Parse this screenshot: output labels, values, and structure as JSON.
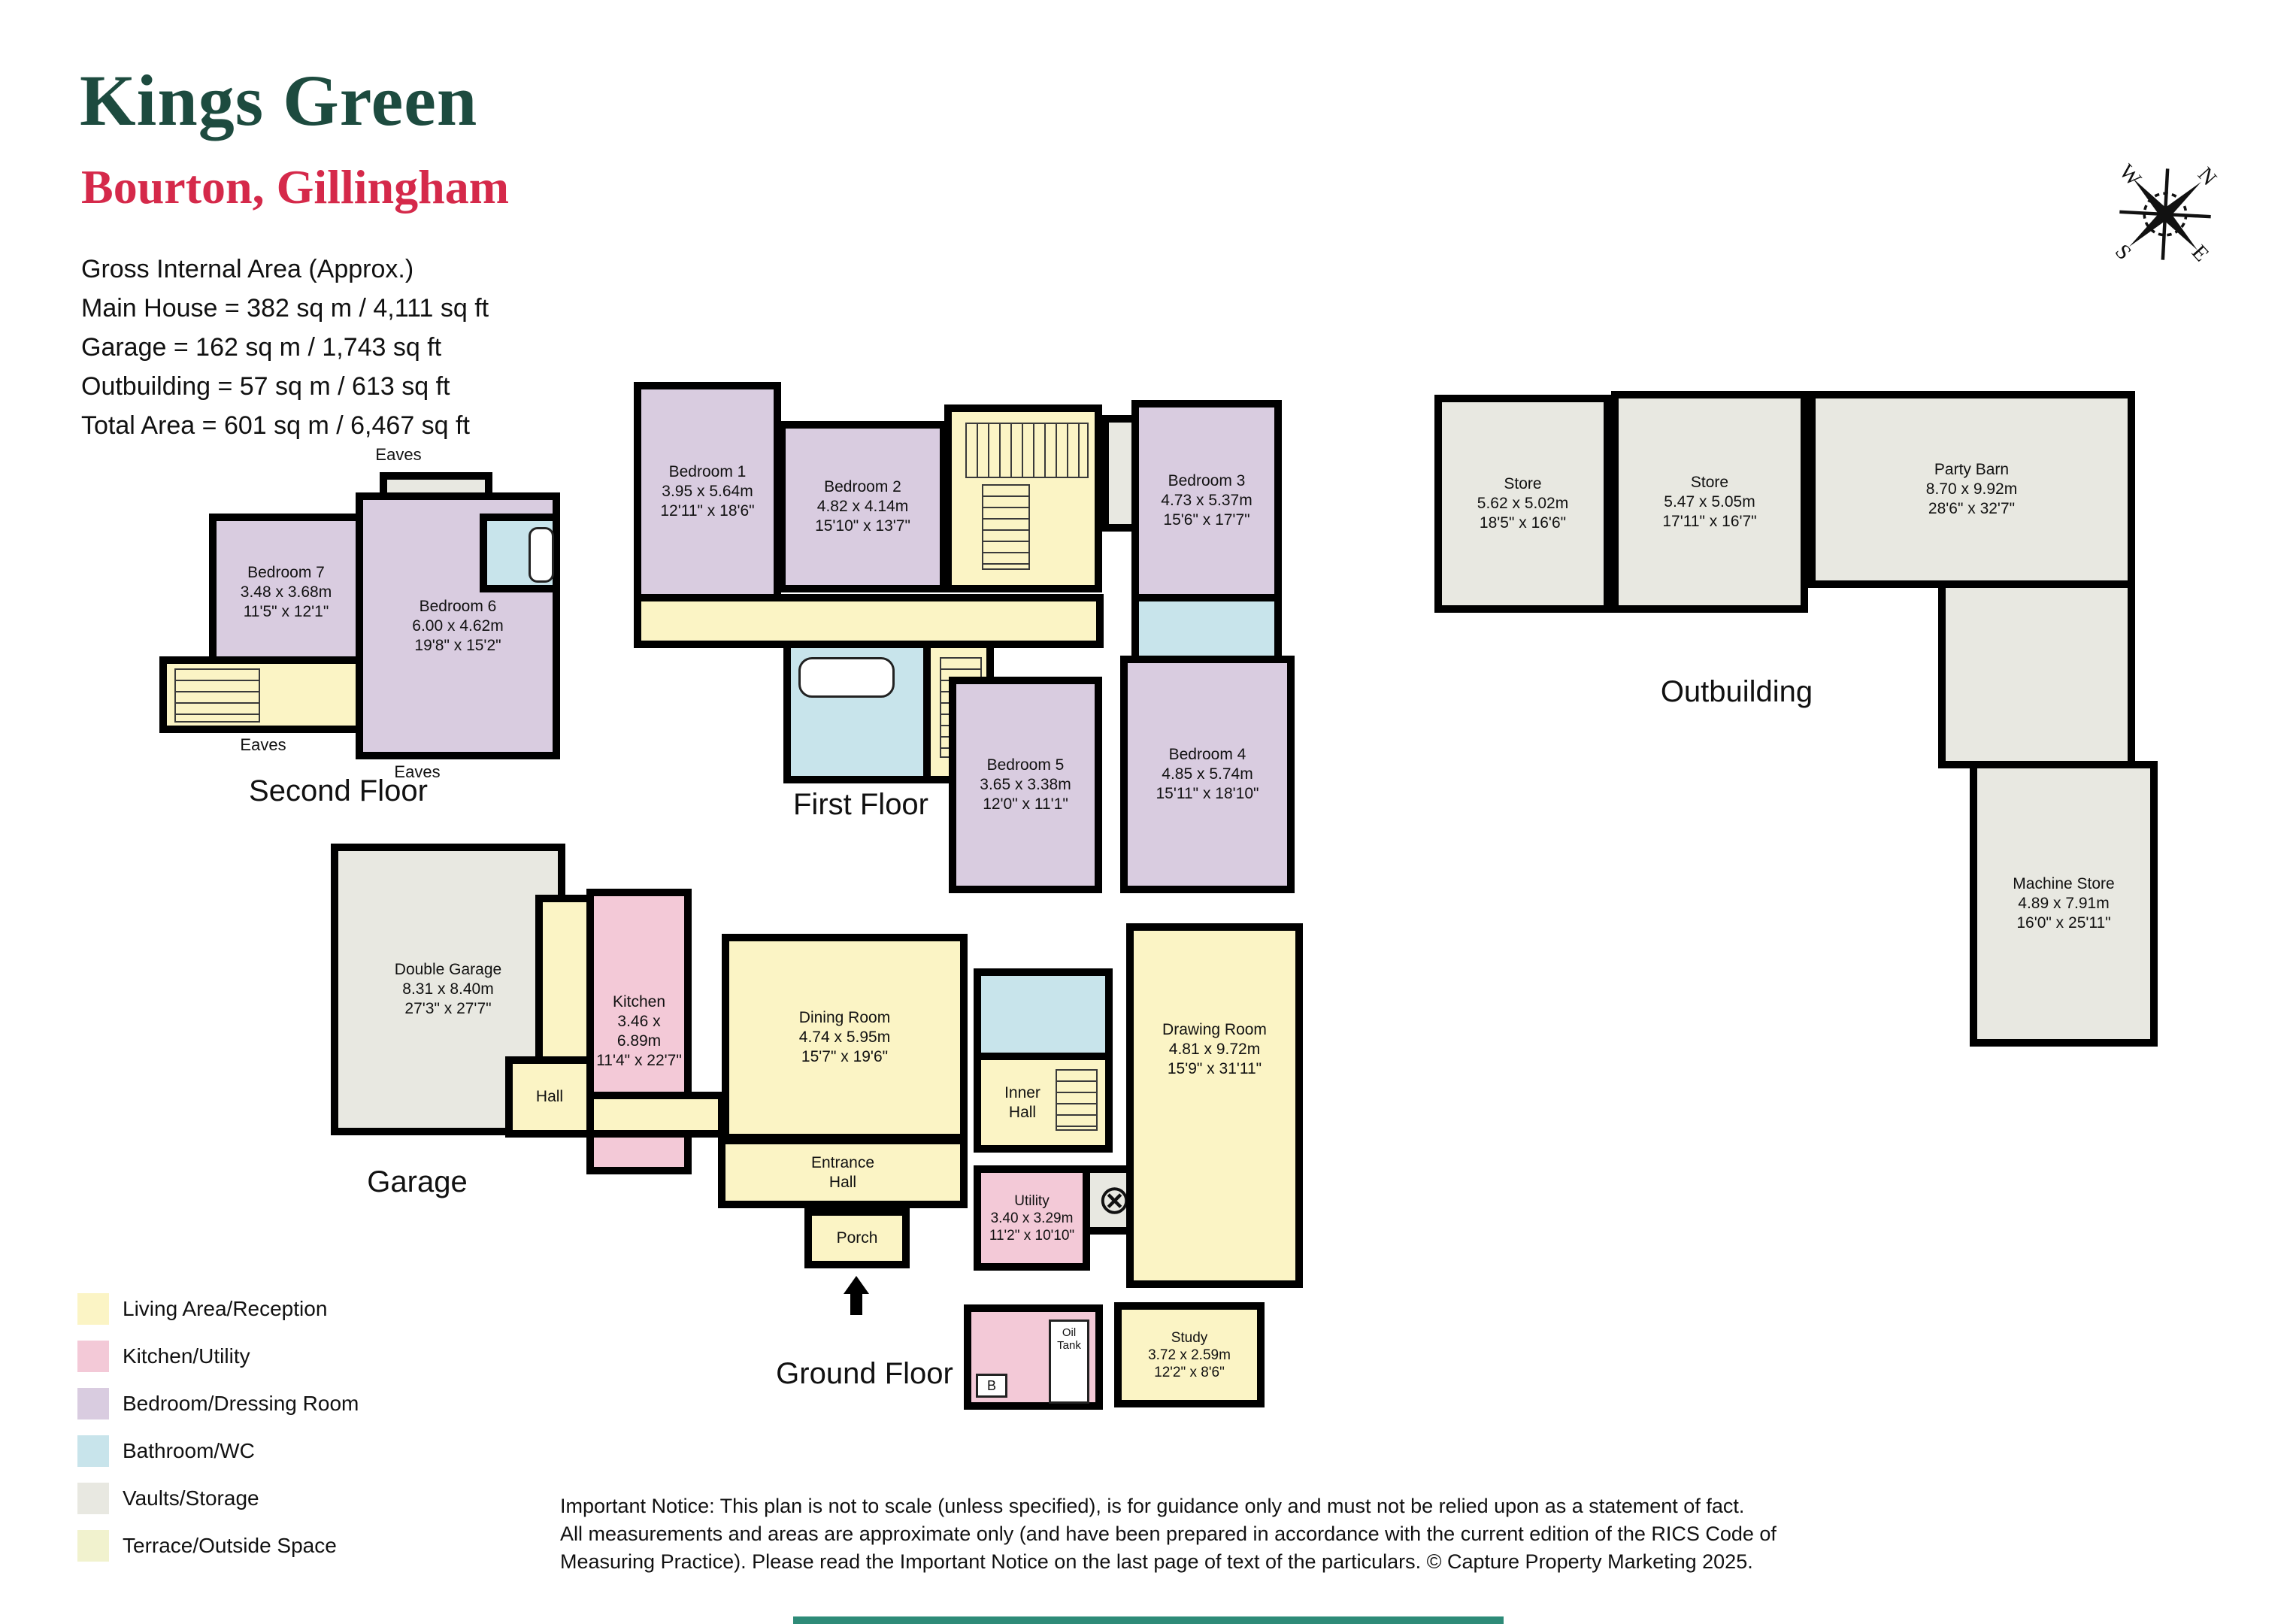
{
  "header": {
    "title": "Kings Green",
    "subtitle": "Bourton, Gillingham",
    "area_heading": "Gross Internal Area (Approx.)",
    "area_line1": "Main House = 382 sq m / 4,111 sq ft",
    "area_line2": "Garage = 162 sq m / 1,743 sq ft",
    "area_line3": "Outbuilding = 57 sq m / 613 sq ft",
    "area_line4": "Total Area = 601 sq m / 6,467 sq ft",
    "title_color": "#1D4B3F",
    "subtitle_color": "#D5294A"
  },
  "compass": {
    "n": "N",
    "e": "E",
    "s": "S",
    "w": "W"
  },
  "floors": {
    "second": {
      "label": "Second Floor",
      "eaves_top": "Eaves",
      "eaves_bottom_left": "Eaves",
      "eaves_bottom_right": "Eaves",
      "rooms": {
        "bedroom7": {
          "name": "Bedroom 7",
          "dims_m": "3.48 x 3.68m",
          "dims_ft": "11'5\" x 12'1\""
        },
        "bedroom6": {
          "name": "Bedroom 6",
          "dims_m": "6.00 x 4.62m",
          "dims_ft": "19'8\" x 15'2\""
        }
      }
    },
    "first": {
      "label": "First Floor",
      "rooms": {
        "bedroom1": {
          "name": "Bedroom 1",
          "dims_m": "3.95 x 5.64m",
          "dims_ft": "12'11\" x 18'6\""
        },
        "bedroom2": {
          "name": "Bedroom 2",
          "dims_m": "4.82 x 4.14m",
          "dims_ft": "15'10\" x 13'7\""
        },
        "bedroom3": {
          "name": "Bedroom 3",
          "dims_m": "4.73 x 5.37m",
          "dims_ft": "15'6\" x 17'7\""
        },
        "bedroom4": {
          "name": "Bedroom 4",
          "dims_m": "4.85 x 5.74m",
          "dims_ft": "15'11\" x 18'10\""
        },
        "bedroom5": {
          "name": "Bedroom 5",
          "dims_m": "3.65 x 3.38m",
          "dims_ft": "12'0\" x 11'1\""
        }
      }
    },
    "ground": {
      "label": "Ground Floor",
      "garage_caption": "Garage",
      "boiler_glyph": "⊗",
      "boiler_letter": "B",
      "rooms": {
        "double_garage": {
          "name": "Double Garage",
          "dims_m": "8.31 x 8.40m",
          "dims_ft": "27'3\" x 27'7\""
        },
        "hall": {
          "name": "Hall"
        },
        "kitchen": {
          "name": "Kitchen",
          "dims_m": "3.46 x 6.89m",
          "dims_ft": "11'4\" x 22'7\""
        },
        "dining": {
          "name": "Dining Room",
          "dims_m": "4.74 x 5.95m",
          "dims_ft": "15'7\" x 19'6\""
        },
        "inner_hall": {
          "name": "Inner Hall"
        },
        "entrance_hall": {
          "name": "Entrance Hall"
        },
        "porch": {
          "name": "Porch"
        },
        "utility": {
          "name": "Utility",
          "dims_m": "3.40 x 3.29m",
          "dims_ft": "11'2\" x 10'10\""
        },
        "drawing": {
          "name": "Drawing Room",
          "dims_m": "4.81 x 9.72m",
          "dims_ft": "15'9\" x 31'11\""
        },
        "study": {
          "name": "Study",
          "dims_m": "3.72 x 2.59m",
          "dims_ft": "12'2\" x 8'6\""
        },
        "oil_tank": {
          "name": "Oil Tank"
        }
      }
    },
    "outbuilding": {
      "label": "Outbuilding",
      "rooms": {
        "store1": {
          "name": "Store",
          "dims_m": "5.62 x 5.02m",
          "dims_ft": "18'5\" x 16'6\""
        },
        "store2": {
          "name": "Store",
          "dims_m": "5.47 x 5.05m",
          "dims_ft": "17'11\" x 16'7\""
        },
        "party_barn": {
          "name": "Party Barn",
          "dims_m": "8.70 x 9.92m",
          "dims_ft": "28'6\" x 32'7\""
        },
        "machine_store": {
          "name": "Machine Store",
          "dims_m": "4.89 x 7.91m",
          "dims_ft": "16'0\" x 25'11\""
        }
      }
    }
  },
  "legend": {
    "items": [
      {
        "label": "Living Area/Reception",
        "color": "#FBF4C5"
      },
      {
        "label": "Kitchen/Utility",
        "color": "#F3C9D7"
      },
      {
        "label": "Bedroom/Dressing Room",
        "color": "#D9CCE0"
      },
      {
        "label": "Bathroom/WC",
        "color": "#C8E4EB"
      },
      {
        "label": "Vaults/Storage",
        "color": "#E8E8E1"
      },
      {
        "label": "Terrace/Outside Space",
        "color": "#F1F2CE"
      }
    ]
  },
  "notice": {
    "line1": "Important Notice: This plan is not to scale (unless specified), is for guidance only and must not be relied upon as a statement of fact.",
    "line2": "All measurements and areas are approximate only (and have been prepared in accordance with the current edition of the RICS Code of",
    "line3": "Measuring Practice). Please read the Important Notice on the last page of text of the particulars. © Capture Property Marketing 2025."
  },
  "footer": {
    "bar_color": "#2E8B78"
  },
  "wall_color": "#000000"
}
